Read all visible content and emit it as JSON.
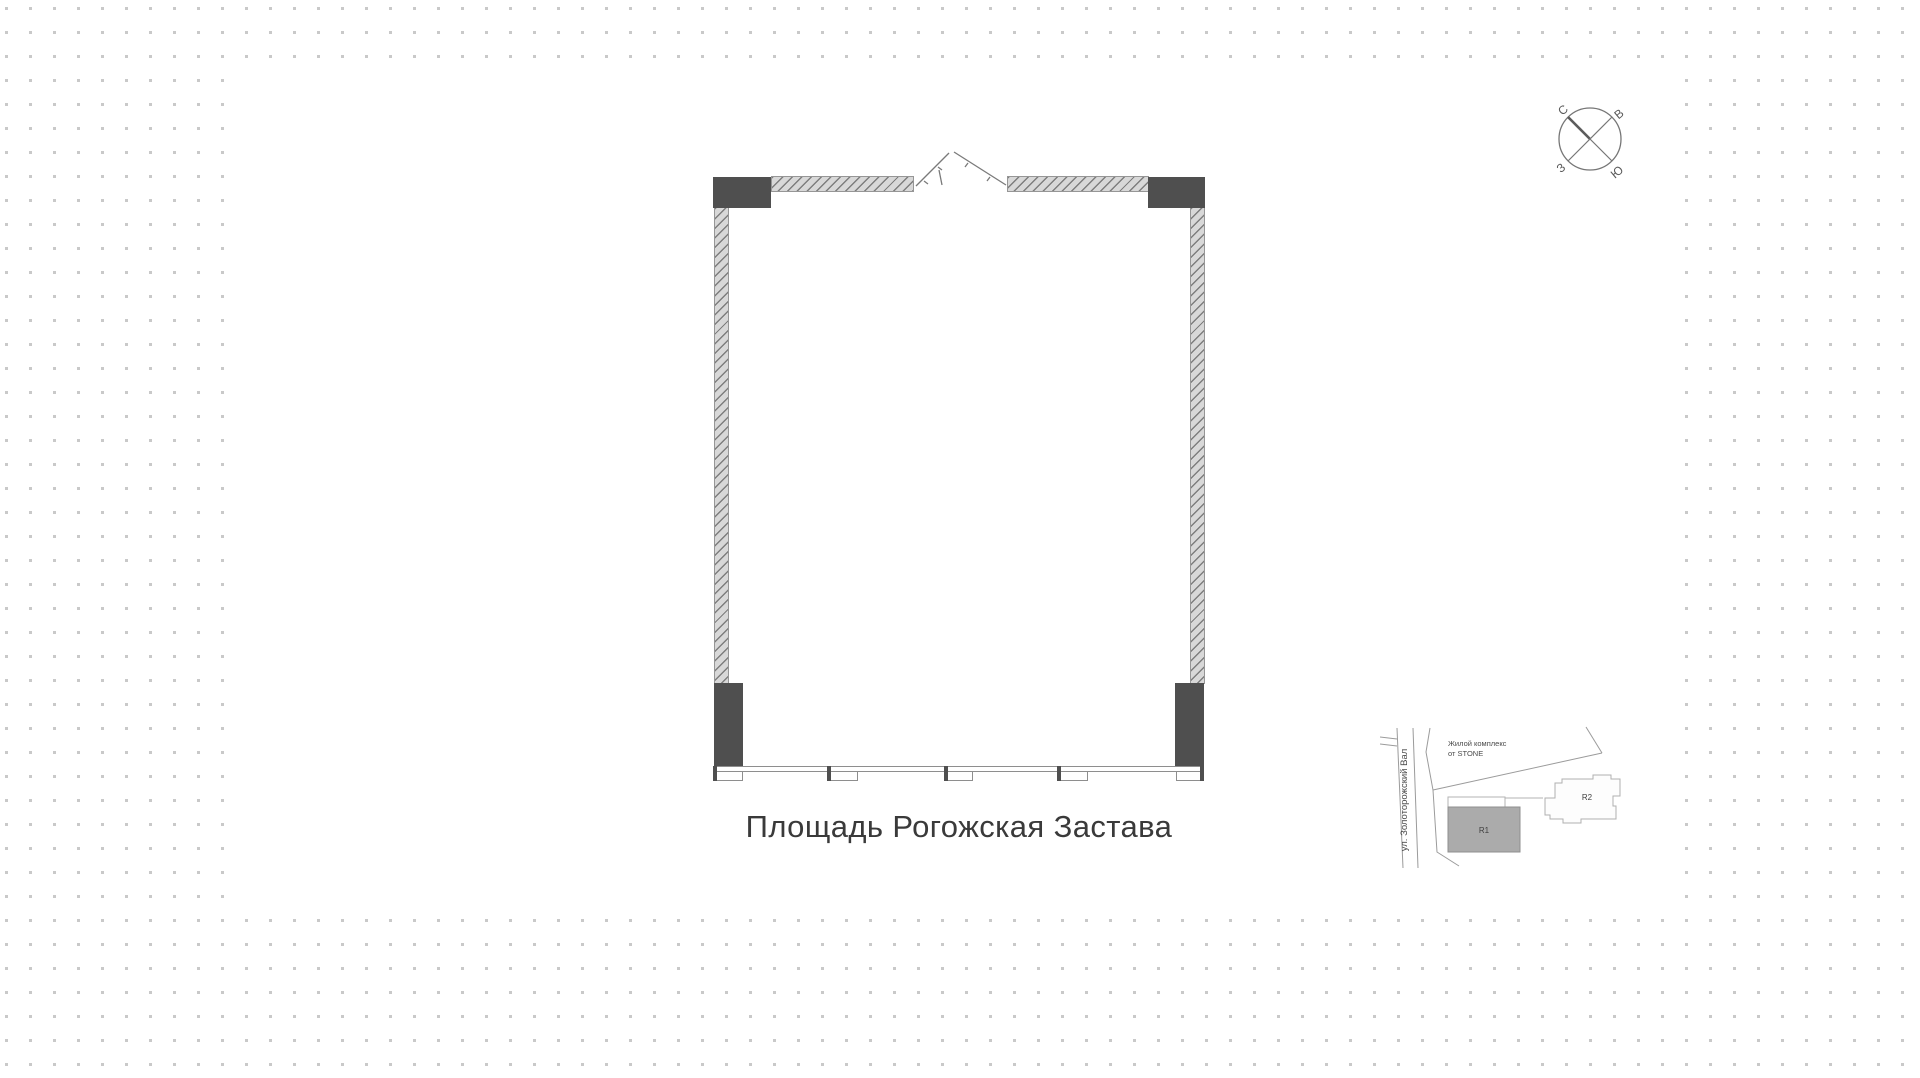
{
  "floorplan": {
    "title": "Площадь Рогожская Застава"
  },
  "compass": {
    "north": "С",
    "east": "В",
    "west": "З",
    "south": "Ю"
  },
  "minimap": {
    "street": "ул. Золоторожский Вал",
    "complex_line1": "Жилой комплекс",
    "complex_line2": "от STONE",
    "building_r1": "R1",
    "building_r2": "R2"
  },
  "colors": {
    "dot_grid": "#c9c9c9",
    "canvas": "#ffffff",
    "column_dark": "#4f4f4f",
    "wall_fill": "#d8d8d8",
    "wall_line": "#969696",
    "title_text": "#3a3a3a"
  }
}
